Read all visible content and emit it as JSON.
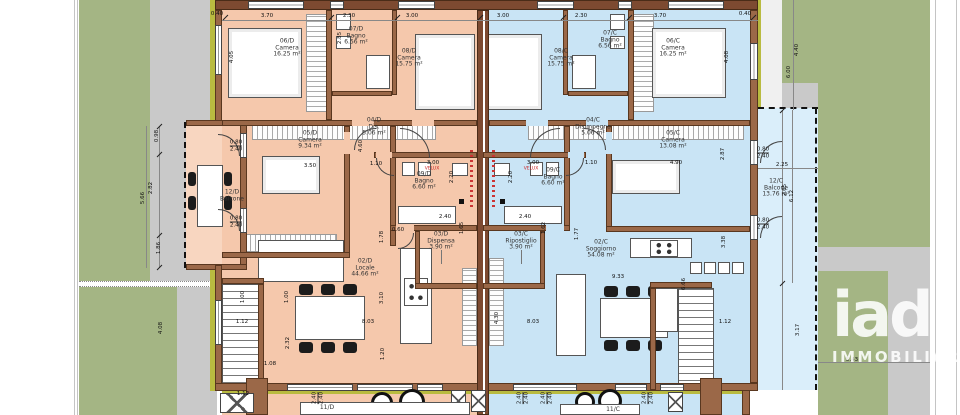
{
  "logo": {
    "brand": "iad",
    "brand_sub": "IMMOBILIARE"
  },
  "colors": {
    "unit_d_fill": "#f5c8ac",
    "unit_c_fill": "#c9e4f5",
    "wall_brown": "#9b6848",
    "wall_dark": "#7d4a31",
    "insulation_olive": "#b9bb40",
    "lawn_green": "#a4b584",
    "path_gray": "#c9c9c9",
    "velux_red": "#cc2222"
  },
  "rooms": [
    {
      "id": "06/D",
      "name": "Camera",
      "area": "16.25 m²",
      "x": 287,
      "y": 48
    },
    {
      "id": "07/D",
      "name": "Bagno",
      "area": "6.56 m²",
      "x": 356,
      "y": 36
    },
    {
      "id": "08/D",
      "name": "Camera",
      "area": "15.75 m²",
      "x": 409,
      "y": 58
    },
    {
      "id": "05/D",
      "name": "Camera",
      "area": "9.34 m²",
      "x": 310,
      "y": 140
    },
    {
      "id": "04/D",
      "name": "Dis.",
      "area": "5.06 m²",
      "x": 374,
      "y": 127
    },
    {
      "id": "09/D",
      "name": "Bagno",
      "area": "6.60 m²",
      "x": 424,
      "y": 181
    },
    {
      "id": "03/D",
      "name": "Dispensa",
      "area": "3.90 m²",
      "x": 441,
      "y": 241
    },
    {
      "id": "02/D",
      "name": "Locale",
      "area": "44.66 m²",
      "x": 365,
      "y": 268
    },
    {
      "id": "12/D",
      "name": "Balcone",
      "area": "",
      "x": 232,
      "y": 196
    },
    {
      "id": "11/D",
      "name": "",
      "area": "",
      "x": 327,
      "y": 408
    },
    {
      "id": "08/C",
      "name": "Camera",
      "area": "15.75 m²",
      "x": 561,
      "y": 58
    },
    {
      "id": "07/C",
      "name": "Bagno",
      "area": "6.56 m²",
      "x": 610,
      "y": 40
    },
    {
      "id": "06/C",
      "name": "Camera",
      "area": "16.25 m²",
      "x": 673,
      "y": 48
    },
    {
      "id": "04/C",
      "name": "Disimpegno",
      "area": "5.06 m²",
      "x": 593,
      "y": 127
    },
    {
      "id": "05/C",
      "name": "Camera",
      "area": "13.08 m²",
      "x": 673,
      "y": 140
    },
    {
      "id": "09/C",
      "name": "Bagno",
      "area": "6.60 m²",
      "x": 553,
      "y": 177
    },
    {
      "id": "03/C",
      "name": "Ripostiglio",
      "area": "3.90 m²",
      "x": 521,
      "y": 241
    },
    {
      "id": "02/C",
      "name": "Soggiorno",
      "area": "54.08 m²",
      "x": 601,
      "y": 249
    },
    {
      "id": "12/C",
      "name": "Balcone",
      "area": "13.76 m²",
      "x": 776,
      "y": 188
    },
    {
      "id": "11/C",
      "name": "",
      "area": "",
      "x": 613,
      "y": 410
    }
  ],
  "annotations": [
    {
      "text": "VELUX",
      "x": 432,
      "y": 169
    },
    {
      "text": "VELUX",
      "x": 531,
      "y": 169
    }
  ],
  "dimensions": [
    {
      "t": "3.70",
      "x": 267,
      "y": 16
    },
    {
      "t": "2.30",
      "x": 349,
      "y": 16
    },
    {
      "t": "3.00",
      "x": 412,
      "y": 16
    },
    {
      "t": "3.00",
      "x": 503,
      "y": 16
    },
    {
      "t": "2.30",
      "x": 581,
      "y": 16
    },
    {
      "t": "3.70",
      "x": 660,
      "y": 16
    },
    {
      "t": "0.40",
      "x": 217,
      "y": 14
    },
    {
      "t": "0.40",
      "x": 745,
      "y": 14
    },
    {
      "t": "4.05",
      "x": 232,
      "y": 57,
      "r": 1
    },
    {
      "t": "2.85",
      "x": 340,
      "y": 38,
      "r": 1
    },
    {
      "t": "4.08",
      "x": 727,
      "y": 57,
      "r": 1
    },
    {
      "t": "0.98",
      "x": 157,
      "y": 136,
      "r": 1
    },
    {
      "t": "2.82",
      "x": 151,
      "y": 188,
      "r": 1
    },
    {
      "t": "5.66",
      "x": 143,
      "y": 198,
      "r": 1
    },
    {
      "t": "1.86",
      "x": 159,
      "y": 248,
      "r": 1
    },
    {
      "t": "0.80|2.40",
      "x": 236,
      "y": 146
    },
    {
      "t": "0.80|2.40",
      "x": 236,
      "y": 222
    },
    {
      "t": "3.50",
      "x": 310,
      "y": 166
    },
    {
      "t": "1.10",
      "x": 376,
      "y": 164
    },
    {
      "t": "3.00",
      "x": 433,
      "y": 163
    },
    {
      "t": "4.60",
      "x": 361,
      "y": 146,
      "r": 1
    },
    {
      "t": "2.20",
      "x": 452,
      "y": 177,
      "r": 1
    },
    {
      "t": "2.40",
      "x": 445,
      "y": 217
    },
    {
      "t": "1.65",
      "x": 462,
      "y": 228,
      "r": 1
    },
    {
      "t": "1.78",
      "x": 382,
      "y": 237,
      "r": 1
    },
    {
      "t": "0.60",
      "x": 398,
      "y": 230
    },
    {
      "t": "8.03",
      "x": 368,
      "y": 322
    },
    {
      "t": "3.10",
      "x": 382,
      "y": 298,
      "r": 1
    },
    {
      "t": "2.32",
      "x": 288,
      "y": 343,
      "r": 1
    },
    {
      "t": "1.00",
      "x": 243,
      "y": 297,
      "r": 1
    },
    {
      "t": "1.00",
      "x": 287,
      "y": 297,
      "r": 1
    },
    {
      "t": "1.20",
      "x": 383,
      "y": 354,
      "r": 1
    },
    {
      "t": "1.12",
      "x": 242,
      "y": 322
    },
    {
      "t": "1.08",
      "x": 270,
      "y": 364
    },
    {
      "t": "1.12",
      "x": 243,
      "y": 394
    },
    {
      "t": "4.08",
      "x": 161,
      "y": 328,
      "r": 1
    },
    {
      "t": "3.00",
      "x": 533,
      "y": 163
    },
    {
      "t": "1.10",
      "x": 591,
      "y": 163
    },
    {
      "t": "4.90",
      "x": 676,
      "y": 163
    },
    {
      "t": "2.20",
      "x": 511,
      "y": 177,
      "r": 1
    },
    {
      "t": "2.40",
      "x": 525,
      "y": 217
    },
    {
      "t": "1.62",
      "x": 544,
      "y": 228,
      "r": 1
    },
    {
      "t": "1.77",
      "x": 577,
      "y": 234,
      "r": 1
    },
    {
      "t": "9.33",
      "x": 618,
      "y": 277
    },
    {
      "t": "8.03",
      "x": 533,
      "y": 322
    },
    {
      "t": "4.30",
      "x": 497,
      "y": 318,
      "r": 1
    },
    {
      "t": "6.66",
      "x": 684,
      "y": 284,
      "r": 1
    },
    {
      "t": "3.38",
      "x": 724,
      "y": 242,
      "r": 1
    },
    {
      "t": "1.12",
      "x": 725,
      "y": 322
    },
    {
      "t": "2.87",
      "x": 723,
      "y": 154,
      "r": 1
    },
    {
      "t": "0.80|2.40",
      "x": 763,
      "y": 153
    },
    {
      "t": "0.80|2.40",
      "x": 763,
      "y": 224
    },
    {
      "t": "2.25",
      "x": 782,
      "y": 165
    },
    {
      "t": "2.65",
      "x": 785,
      "y": 190,
      "r": 1
    },
    {
      "t": "6.12",
      "x": 792,
      "y": 196,
      "r": 1
    },
    {
      "t": "4.40",
      "x": 797,
      "y": 50,
      "r": 1
    },
    {
      "t": "6.00",
      "x": 789,
      "y": 72,
      "r": 1
    },
    {
      "t": "3.17",
      "x": 798,
      "y": 330,
      "r": 1
    },
    {
      "t": "5.43",
      "x": 852,
      "y": 360
    },
    {
      "t": "2.40|2.40",
      "x": 318,
      "y": 398,
      "r": 1
    },
    {
      "t": "2.40|2.40",
      "x": 523,
      "y": 398,
      "r": 1
    },
    {
      "t": "2.40|2.40",
      "x": 547,
      "y": 398,
      "r": 1
    },
    {
      "t": "2.40|2.40",
      "x": 648,
      "y": 398,
      "r": 1
    }
  ]
}
